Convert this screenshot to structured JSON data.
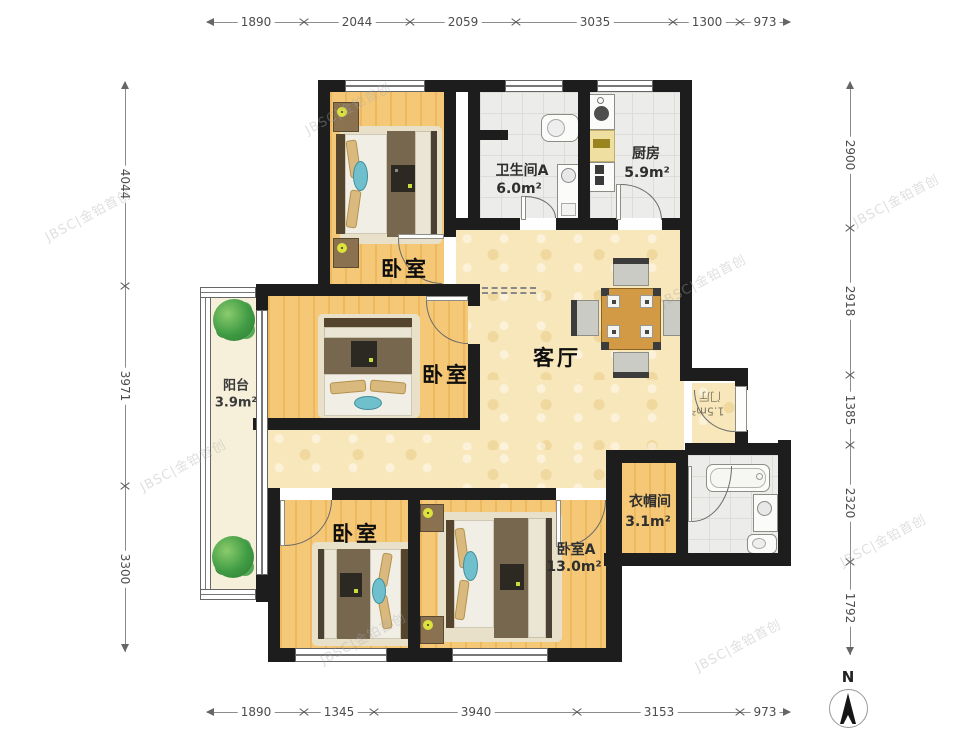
{
  "watermark": {
    "text": "JBSC|金铂首创"
  },
  "compass": {
    "label": "N"
  },
  "rooms": {
    "bedroom_top": {
      "label": "卧室"
    },
    "bedroom_mid": {
      "label": "卧室"
    },
    "bedroom_bottom": {
      "label": "卧室"
    },
    "bedroom_a": {
      "label": "卧室A",
      "area": "13.0m²"
    },
    "living": {
      "label": "客厅"
    },
    "bathroom_a": {
      "label": "卫生间A",
      "area": "6.0m²"
    },
    "kitchen": {
      "label": "厨房",
      "area": "5.9m²"
    },
    "balcony": {
      "label": "阳台",
      "area": "3.9m²"
    },
    "cloakroom": {
      "label": "衣帽间",
      "area": "3.1m²"
    },
    "entry": {
      "label": "门厅",
      "area": "1.5m²"
    }
  },
  "dimensions": {
    "top": [
      "1890",
      "2044",
      "2059",
      "3035",
      "1300",
      "973"
    ],
    "bottom": [
      "1890",
      "1345",
      "3940",
      "3153",
      "973"
    ],
    "left": [
      "4044",
      "3971",
      "3300"
    ],
    "right": [
      "2900",
      "2918",
      "1385",
      "2320",
      "1792"
    ]
  }
}
